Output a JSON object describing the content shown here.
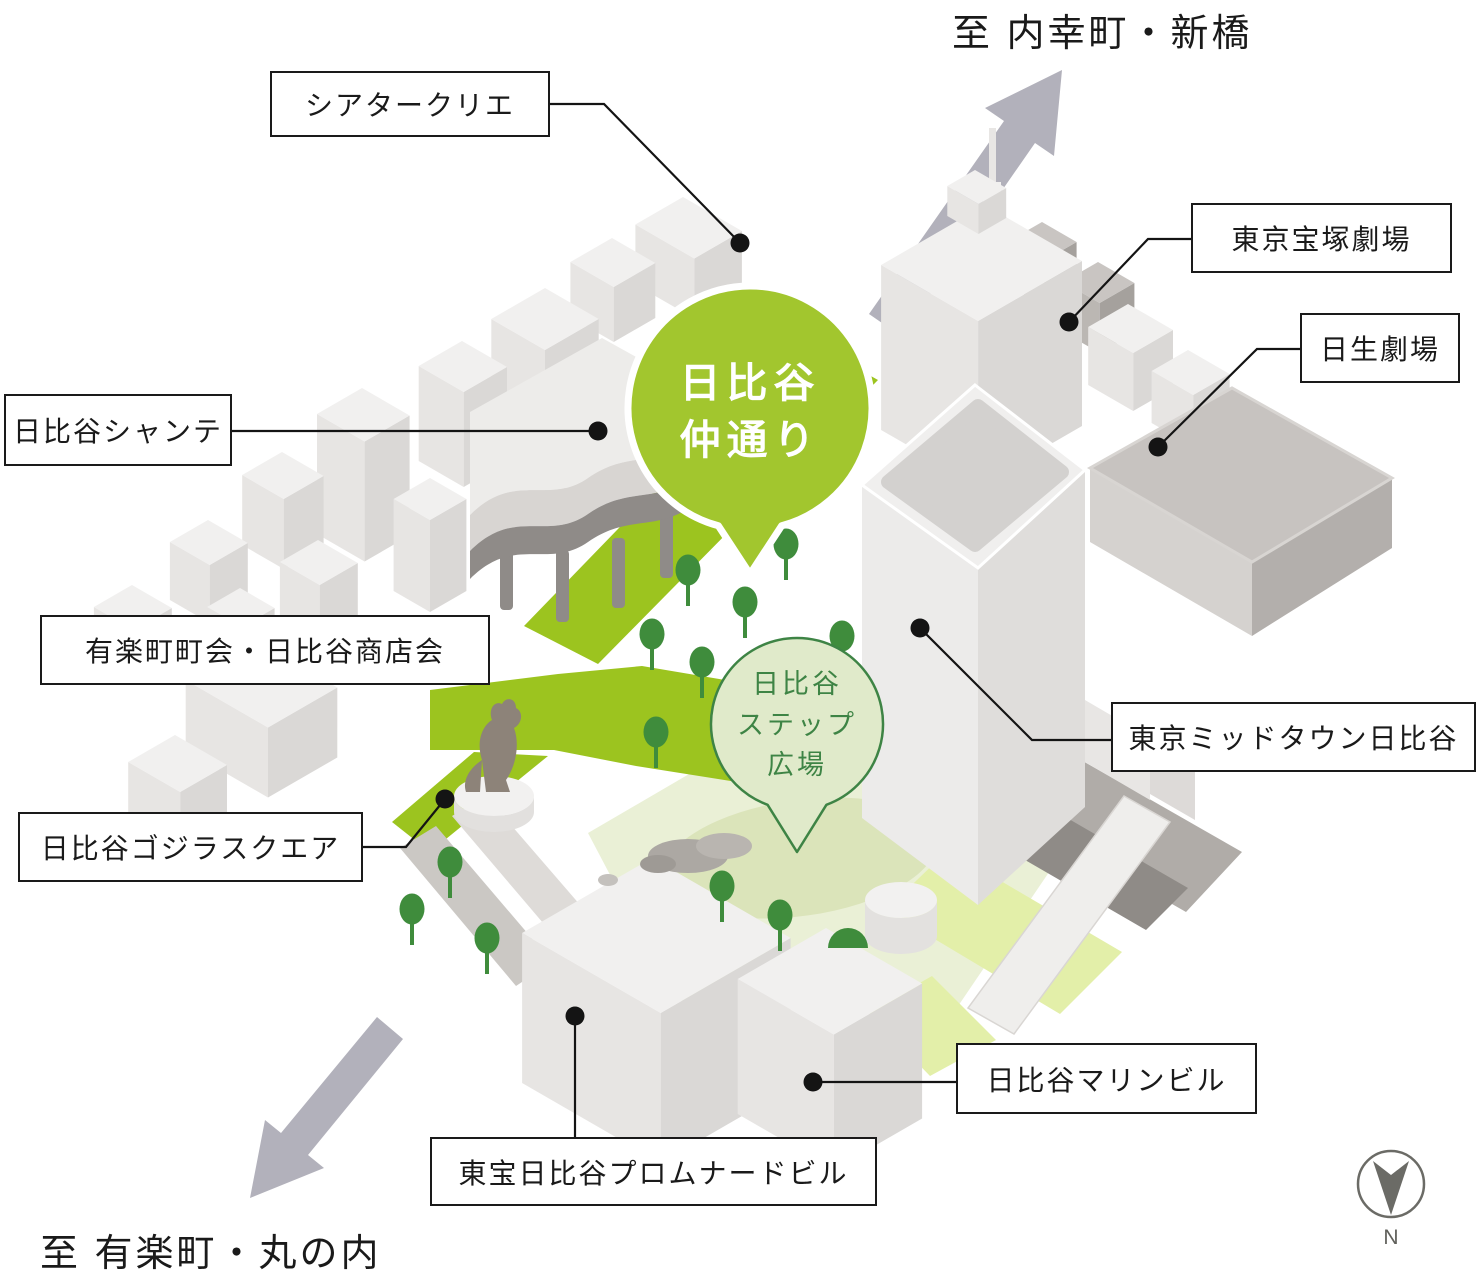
{
  "directions": {
    "north": "至 内幸町・新橋",
    "south": "至 有楽町・丸の内"
  },
  "bubbles": {
    "naka_dori": "日比谷\n仲通り",
    "step_plaza": "日比谷\nステップ\n広場"
  },
  "labels": {
    "theatre_creation": "シアタークリエ",
    "takarazuka": "東京宝塚劇場",
    "nissay": "日生劇場",
    "chanter": "日比谷シャンテ",
    "chokai": "有楽町町会・日比谷商店会",
    "midtown": "東京ミッドタウン日比谷",
    "godzilla_square": "日比谷ゴジラスクエア",
    "marine": "日比谷マリンビル",
    "promenade": "東宝日比谷プロムナードビル"
  },
  "compass": {
    "north_label": "N"
  },
  "colors": {
    "road_green": "#9CC41F",
    "bubble_green": "#A2C62E",
    "plaza_green": "#EAF0D6",
    "tree_green": "#3F8C3C",
    "step_outline": "#3E8445",
    "arrow_gray": "#B2B1BB"
  }
}
